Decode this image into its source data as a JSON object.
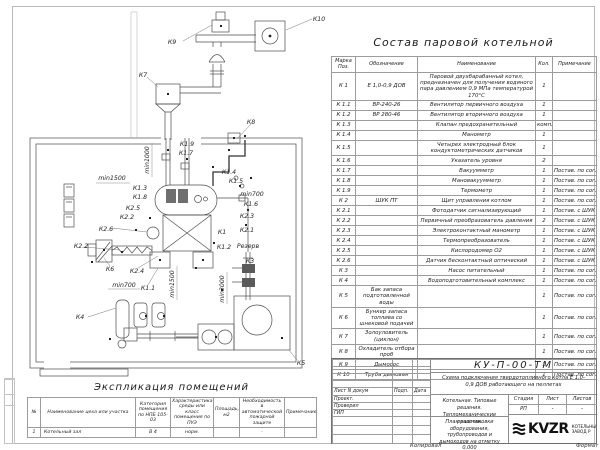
{
  "colors": {
    "line": "#4d4d4d",
    "text": "#1e1e1e",
    "frame": "#b9b9b9",
    "logo": "#111111"
  },
  "plan": {
    "labels": {
      "k1": "К1",
      "k11": "К1.1",
      "k12": "К1.2",
      "k13": "К1.3",
      "k14": "К1.4",
      "k15": "К1.5",
      "k16": "К1.6",
      "k17": "К1.7",
      "k18": "К1.8",
      "k19": "К1.9",
      "k21": "К2.1",
      "k22": "К2.2",
      "k23": "К2.3",
      "k24": "К2.4",
      "k25": "К2.5",
      "k26": "К2.6",
      "k3": "К3",
      "k4": "К4",
      "k5": "К5",
      "k6": "К6",
      "k7": "К7",
      "k8": "К8",
      "k9": "К9",
      "k10": "К10",
      "reserve": "Резерв",
      "dim_min1000": "min1000",
      "dim_min1500": "min1500",
      "dim_min700": "min700",
      "dim_min3000": "min3000"
    }
  },
  "equipment_table": {
    "title": "Состав паровой котельной",
    "headers": {
      "pos": "Марка Поз.",
      "designation": "Обозначение",
      "name": "Наименование",
      "qty": "Кол.",
      "note": "Примечание"
    },
    "rows": [
      {
        "pos": "К 1",
        "designation": "Е 1,0-0,9 ДОВ",
        "name": "Паровой двухбарабанный котел, предназначен для получения водяного пара давлением 0,9 МПа температурой 170°С",
        "qty": "1",
        "note": ""
      },
      {
        "pos": "К 1.1",
        "designation": "ВР-240-26",
        "name": "Вентилятор первичного воздуха",
        "qty": "1",
        "note": ""
      },
      {
        "pos": "К 1.2",
        "designation": "ВР 280-46",
        "name": "Вентилятор вторичного воздуха",
        "qty": "1",
        "note": ""
      },
      {
        "pos": "К 1.3",
        "designation": "",
        "name": "Клапан предохранительный",
        "qty": "компл.",
        "note": ""
      },
      {
        "pos": "К 1.4",
        "designation": "",
        "name": "Манометр",
        "qty": "1",
        "note": ""
      },
      {
        "pos": "К 1.5",
        "designation": "",
        "name": "Четырех электродный блок кондуктометрических датчиков",
        "qty": "1",
        "note": ""
      },
      {
        "pos": "К 1.6",
        "designation": "",
        "name": "Указатель уровня",
        "qty": "2",
        "note": ""
      },
      {
        "pos": "К 1.7",
        "designation": "",
        "name": "Вакуумметр",
        "qty": "1",
        "note": "Постав. по согл."
      },
      {
        "pos": "К 1.8",
        "designation": "",
        "name": "Мановакуумметр",
        "qty": "1",
        "note": "Постав. по согл."
      },
      {
        "pos": "К 1.9",
        "designation": "",
        "name": "Термометр",
        "qty": "1",
        "note": "Постав. по согл."
      },
      {
        "pos": "К 2",
        "designation": "ШУК ПТ",
        "name": "Щит управления котлом",
        "qty": "1",
        "note": "Постав. по согл."
      },
      {
        "pos": "К 2.1",
        "designation": "",
        "name": "Фотодатчик сигнализирующий",
        "qty": "1",
        "note": "Постав. с ШУК"
      },
      {
        "pos": "К 2.2",
        "designation": "",
        "name": "Первичный преобразователь давления",
        "qty": "2",
        "note": "Постав. с ШУК"
      },
      {
        "pos": "К 2.3",
        "designation": "",
        "name": "Электроконтактный манометр",
        "qty": "1",
        "note": "Постав. с ШУК"
      },
      {
        "pos": "К 2.4",
        "designation": "",
        "name": "Термопреобразователь",
        "qty": "1",
        "note": "Постав. с ШУК"
      },
      {
        "pos": "К 2.5",
        "designation": "",
        "name": "Кислородомер О2",
        "qty": "1",
        "note": "Постав. с ШУК"
      },
      {
        "pos": "К 2.6",
        "designation": "",
        "name": "Датчик бесконтактный оптический",
        "qty": "1",
        "note": "Постав. с ШУК"
      },
      {
        "pos": "К 3",
        "designation": "",
        "name": "Насос питательный",
        "qty": "1",
        "note": "Постав. по согл."
      },
      {
        "pos": "К 4",
        "designation": "",
        "name": "Водоподготовительный комплекс",
        "qty": "1",
        "note": "Постав. по согл."
      },
      {
        "pos": "К 5",
        "designation": "Бак запаса подготовленной воды",
        "name": "",
        "qty": "1",
        "note": "Постав. по согл."
      },
      {
        "pos": "К 6",
        "designation": "Бункер запаса топлива со шнековой подачей",
        "name": "",
        "qty": "1",
        "note": "Постав. по согл."
      },
      {
        "pos": "К 7",
        "designation": "Золоуловитель (циклон)",
        "name": "",
        "qty": "1",
        "note": "Постав. по согл."
      },
      {
        "pos": "К 8",
        "designation": "Охладитель отбора проб",
        "name": "",
        "qty": "1",
        "note": "Постав. по согл."
      },
      {
        "pos": "К 9",
        "designation": "Дымосос",
        "name": "",
        "qty": "1",
        "note": "Постав. по согл."
      },
      {
        "pos": "К 10",
        "designation": "Труба дымовая",
        "name": "",
        "qty": "1",
        "note": "Постав. по согл."
      }
    ]
  },
  "explication_table": {
    "title": "Экспликация помещений",
    "headers": {
      "num": "№",
      "name": "Наименование цеха или участка",
      "category": "Категория помещения по НПБ 105-03",
      "env": "Характеристика среды или класс помещения по ПУЭ",
      "area": "Площадь, м2",
      "fire": "Необходимость в автоматической пожарной защите",
      "note": "Примечание"
    },
    "rows": [
      {
        "num": "1",
        "name": "Котельный зал",
        "category": "В 4",
        "env": "норм.",
        "area": "",
        "fire": "-",
        "note": ""
      }
    ]
  },
  "titleblock": {
    "doc_number": "КУ-П-00-ТМ",
    "doc_title": "Схема подключения твердотопливного котла Е 1,0-0,9 ДОВ работающего на пеллетах",
    "object_line1": "Котельная. Типовые решения.",
    "object_line2": "Тепломеханические решения.",
    "sheet_name": "План расстановки оборудования, трубопроводов и дымоходов на отметку 0,000",
    "sig_header": "Лист N докум",
    "sig_sign": "Подп.",
    "sig_date": "Дата",
    "role_1": "Проект.",
    "role_2": "Проверил",
    "role_3": "ГИП",
    "stage_label": "Стадия",
    "sheet_label": "Лист",
    "sheets_label": "Листов",
    "stage_value": "РП",
    "sheet_value": "-",
    "sheets_value": "-",
    "logo_text": "KVZR",
    "company_line1": "КОТЕЛЬНЫЙ",
    "company_line2": "ЗАВОД Р"
  },
  "footer": {
    "copied": "Копировал",
    "format": "Формат"
  }
}
